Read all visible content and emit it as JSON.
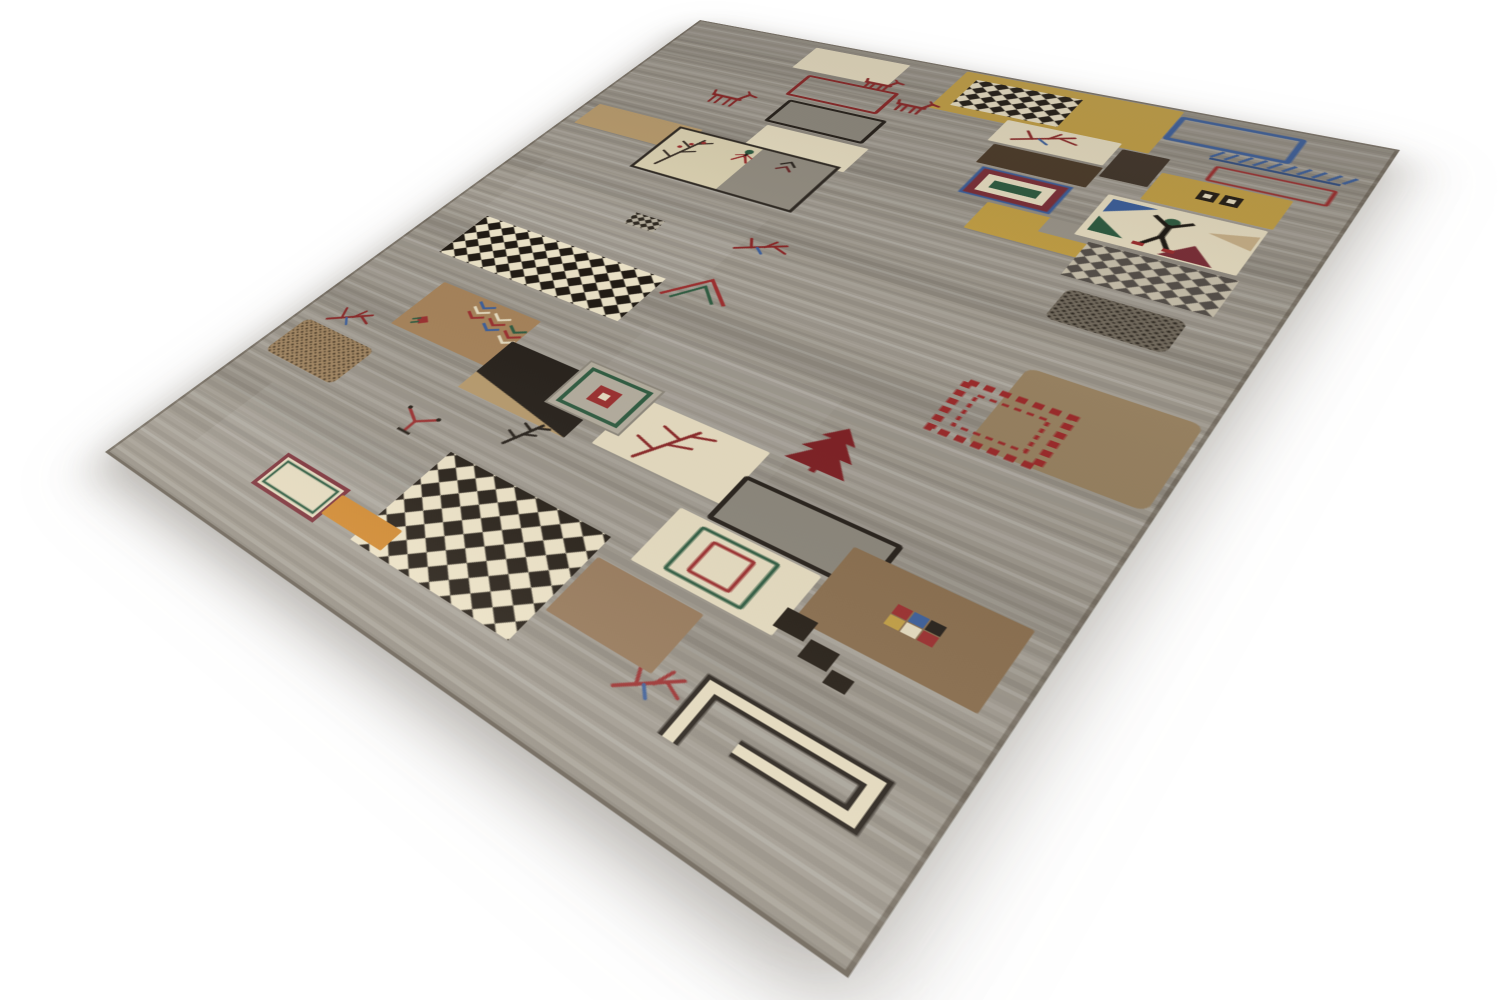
{
  "scene": {
    "description": "Product photograph of a hand-knotted Persian Gabbeh wool rug lying at a three-quarter angle on a plain white studio background. Gray striated field with a patchwork of cream, gold, brown and black squares, diagonal checkerboards and small tribal motifs: goats, birds, twigs, trees, a human figure, chevrons and dashed frames.",
    "background_color": "#ffffff",
    "rug": {
      "field_color": "#9b958a",
      "flat_width": 700,
      "flat_height": 980,
      "palette": {
        "field": "#9b958a",
        "cream": "#e7ddc1",
        "gold": "#c3a045",
        "tan": "#b99c6e",
        "tanlight": "#c9b189",
        "brown": "#a7835a",
        "brown2": "#968060",
        "brown3": "#8a6e4e",
        "brown4": "#97795a",
        "darkbrown": "#4c3b29",
        "darkbrown2": "#41352a",
        "blackish": "#26201a",
        "grayblock": "#8e897e",
        "grayblock2": "#8b867b",
        "blue": "#3c5f9b",
        "green": "#2f5c41",
        "red": "#9c2f2f",
        "darkred": "#8a2626",
        "maroon": "#7c2f38",
        "maroon2": "#7e2024",
        "orange": "#d2892e",
        "white": "#ffffff"
      },
      "motifs": [
        {
          "id": "gold-band",
          "type": "rect",
          "x": 330,
          "y": 4,
          "w": 205,
          "h": 90,
          "fill": "gold"
        },
        {
          "id": "checker-top",
          "type": "checker",
          "x": 346,
          "y": 18,
          "w": 104,
          "h": 62,
          "c1": "#211b14",
          "c2": "#e9dfc4",
          "cell": 11
        },
        {
          "id": "cream-rect-1",
          "type": "rect",
          "x": 163,
          "y": 14,
          "w": 110,
          "h": 55,
          "fill": "cream"
        },
        {
          "id": "goat-2",
          "type": "goat",
          "x": 248,
          "y": 52,
          "w": 38,
          "h": 28,
          "color": "darkred"
        },
        {
          "id": "red-outline-rect",
          "type": "rect",
          "x": 190,
          "y": 80,
          "w": 100,
          "h": 48,
          "stroke": "darkred",
          "sw": 4
        },
        {
          "id": "gray-outline-rect",
          "type": "rect",
          "x": 200,
          "y": 140,
          "w": 106,
          "h": 50,
          "fill": "grayblock",
          "stroke": "blackish",
          "sw": 4
        },
        {
          "id": "cream-rect-2",
          "type": "rect",
          "x": 206,
          "y": 198,
          "w": 112,
          "h": 52,
          "fill": "cream"
        },
        {
          "id": "goat-1",
          "type": "goat",
          "x": 116,
          "y": 141,
          "w": 48,
          "h": 38,
          "color": "darkred"
        },
        {
          "id": "goat-3",
          "type": "goat",
          "x": 298,
          "y": 82,
          "w": 40,
          "h": 30,
          "color": "darkred"
        },
        {
          "id": "cream-branch-sq",
          "type": "rect",
          "x": 406,
          "y": 86,
          "w": 104,
          "h": 46,
          "fill": "cream"
        },
        {
          "id": "branch-1",
          "type": "branch",
          "x": 424,
          "y": 90,
          "w": 56,
          "h": 36,
          "color": "darkred"
        },
        {
          "id": "dark-bar-2",
          "type": "rect",
          "x": 514,
          "y": 96,
          "w": 40,
          "h": 56,
          "fill": "darkbrown2"
        },
        {
          "id": "dark-bar",
          "type": "rect",
          "x": 414,
          "y": 136,
          "w": 98,
          "h": 40,
          "fill": "darkbrown"
        },
        {
          "id": "concentric-1",
          "type": "concentric",
          "x": 424,
          "y": 182,
          "w": 78,
          "h": 50,
          "rings": [
            "blue",
            "maroon",
            "cream"
          ],
          "center": "green"
        },
        {
          "id": "gold-L",
          "type": "rect",
          "x": 452,
          "y": 238,
          "w": 116,
          "h": 50,
          "fill": "gold"
        },
        {
          "id": "gold-L-notch",
          "type": "rect",
          "x": 506,
          "y": 238,
          "w": 62,
          "h": 26,
          "fill": "field"
        },
        {
          "id": "blue-outline-rect",
          "type": "rect",
          "x": 538,
          "y": 16,
          "w": 96,
          "h": 44,
          "stroke": "blue",
          "sw": 5
        },
        {
          "id": "blue-comb",
          "type": "comb",
          "x": 580,
          "y": 62,
          "w": 110,
          "h": 22,
          "color": "blue"
        },
        {
          "id": "red-thin-rect",
          "type": "rect",
          "x": 590,
          "y": 92,
          "w": 88,
          "h": 26,
          "stroke": "red",
          "sw": 3
        },
        {
          "id": "gold-sq-68",
          "type": "rect",
          "x": 556,
          "y": 122,
          "w": 100,
          "h": 52,
          "fill": "gold"
        },
        {
          "id": "motif-68",
          "type": "dblsq",
          "x": 592,
          "y": 136,
          "w": 32,
          "h": 17
        },
        {
          "id": "figure-square",
          "type": "rect",
          "x": 532,
          "y": 178,
          "w": 122,
          "h": 76,
          "fill": "cream"
        },
        {
          "id": "tri-blue",
          "type": "tri",
          "x": 538,
          "y": 184,
          "w": 36,
          "h": 24,
          "fill": "blue",
          "dir": "tl"
        },
        {
          "id": "tri-green",
          "type": "tri",
          "x": 538,
          "y": 216,
          "w": 28,
          "h": 26,
          "fill": "green",
          "dir": "bl"
        },
        {
          "id": "tri-maroon",
          "type": "tri",
          "x": 596,
          "y": 226,
          "w": 40,
          "h": 26,
          "fill": "maroon",
          "dir": "b"
        },
        {
          "id": "tri-tan",
          "type": "tri",
          "x": 618,
          "y": 190,
          "w": 34,
          "h": 24,
          "fill": "tanlight",
          "dir": "r"
        },
        {
          "id": "human-figure",
          "type": "human",
          "x": 572,
          "y": 192,
          "w": 36,
          "h": 52
        },
        {
          "id": "checker-gray",
          "type": "checker",
          "x": 546,
          "y": 260,
          "w": 112,
          "h": 58,
          "c1": "#56504a",
          "c2": "#c8c0ac",
          "cell": 10
        },
        {
          "id": "speckle-dark",
          "type": "speckle",
          "x": 558,
          "y": 334,
          "w": 88,
          "h": 48,
          "base": "#746c5f",
          "dots": "#2d2720"
        },
        {
          "id": "tan-sq",
          "type": "rect",
          "x": 16,
          "y": 238,
          "w": 136,
          "h": 50,
          "fill": "tan"
        },
        {
          "id": "panel-left",
          "type": "panel",
          "x": 128,
          "y": 244,
          "w": 182,
          "h": 94
        },
        {
          "id": "bug-1",
          "type": "bug",
          "x": 206,
          "y": 252,
          "w": 26,
          "h": 26
        },
        {
          "id": "branch-mid",
          "type": "branch",
          "x": 298,
          "y": 388,
          "w": 46,
          "h": 36,
          "color": "darkred"
        },
        {
          "id": "mini-check",
          "type": "checker",
          "x": 184,
          "y": 412,
          "w": 34,
          "h": 22,
          "c1": "#302a22",
          "c2": "#b3ac9c",
          "cell": 6
        },
        {
          "id": "checker-left",
          "type": "checker",
          "x": 54,
          "y": 494,
          "w": 218,
          "h": 78,
          "c1": "#211b14",
          "c2": "#ece3c8",
          "cell": 13
        },
        {
          "id": "arrow-pair",
          "type": "arrows",
          "x": 280,
          "y": 474,
          "w": 58,
          "h": 42
        },
        {
          "id": "chevron-sq",
          "type": "rect",
          "x": 94,
          "y": 610,
          "w": 120,
          "h": 80,
          "fill": "brown"
        },
        {
          "id": "chevrons",
          "type": "chevrons",
          "x": 146,
          "y": 616,
          "w": 72,
          "h": 46
        },
        {
          "id": "rose",
          "type": "rose",
          "x": 108,
          "y": 660,
          "w": 18,
          "h": 18
        },
        {
          "id": "black-sq",
          "type": "rect",
          "x": 210,
          "y": 648,
          "w": 116,
          "h": 78,
          "fill": "blackish"
        },
        {
          "id": "black-sq-streak",
          "type": "tri",
          "x": 210,
          "y": 700,
          "w": 116,
          "h": 26,
          "fill": "tan",
          "dir": "bl"
        },
        {
          "id": "cream-branch-sq-2",
          "type": "rect",
          "x": 348,
          "y": 648,
          "w": 118,
          "h": 70,
          "fill": "cream"
        },
        {
          "id": "tree-twig",
          "type": "tree",
          "x": 374,
          "y": 656,
          "w": 62,
          "h": 56,
          "color": "darkred"
        },
        {
          "id": "concentric-2",
          "type": "concentric2",
          "x": 286,
          "y": 632,
          "w": 74,
          "h": 66
        },
        {
          "id": "red-tree",
          "type": "pine",
          "x": 476,
          "y": 590,
          "w": 48,
          "h": 58,
          "color": "maroon2"
        },
        {
          "id": "brown-sq-right",
          "type": "rect",
          "x": 574,
          "y": 450,
          "w": 120,
          "h": 108,
          "fill": "brown2",
          "rx": 8
        },
        {
          "id": "ladder-frame",
          "type": "ladder",
          "x": 546,
          "y": 490,
          "w": 76,
          "h": 66,
          "color": "#9a2b2b"
        },
        {
          "id": "gray-outline-rect-2",
          "type": "rect",
          "x": 466,
          "y": 682,
          "w": 118,
          "h": 52,
          "fill": "grayblock2",
          "stroke": "blackish",
          "sw": 4
        },
        {
          "id": "cream-concentric-sq",
          "type": "rect",
          "x": 444,
          "y": 738,
          "w": 112,
          "h": 66,
          "fill": "cream"
        },
        {
          "id": "green-rect-line",
          "type": "rect",
          "x": 468,
          "y": 746,
          "w": 60,
          "h": 50,
          "stroke": "green",
          "sw": 3
        },
        {
          "id": "red-rect-line",
          "type": "rect",
          "x": 482,
          "y": 754,
          "w": 32,
          "h": 34,
          "stroke": "red",
          "sw": 3
        },
        {
          "id": "brown-sq-bottom",
          "type": "rect",
          "x": 560,
          "y": 700,
          "w": 120,
          "h": 82,
          "fill": "brown3"
        },
        {
          "id": "mini-squares",
          "type": "minis",
          "x": 606,
          "y": 730,
          "w": 34,
          "h": 22
        },
        {
          "id": "black-steps",
          "type": "steps",
          "x": 552,
          "y": 776,
          "w": 84,
          "h": 44
        },
        {
          "id": "hook-motif",
          "type": "hook",
          "x": 538,
          "y": 854,
          "w": 132,
          "h": 66
        },
        {
          "id": "branch-bottom",
          "type": "branch",
          "x": 498,
          "y": 866,
          "w": 40,
          "h": 44,
          "color": "red"
        },
        {
          "id": "speckle-brown",
          "type": "speckle",
          "x": 16,
          "y": 730,
          "w": 94,
          "h": 60,
          "base": "#a28560",
          "dots": "#4c3b26"
        },
        {
          "id": "branch-left",
          "type": "branch",
          "x": 34,
          "y": 686,
          "w": 42,
          "h": 40,
          "color": "darkred"
        },
        {
          "id": "wineglass",
          "type": "wineglass",
          "x": 190,
          "y": 768,
          "w": 38,
          "h": 38
        },
        {
          "id": "plant-dark",
          "type": "tree",
          "x": 284,
          "y": 722,
          "w": 32,
          "h": 38,
          "color": "blackish"
        },
        {
          "id": "checker-bottom",
          "type": "checker",
          "x": 260,
          "y": 794,
          "w": 160,
          "h": 124,
          "c1": "#241d15",
          "c2": "#eee4c8",
          "cell": 15
        },
        {
          "id": "brown-sq-checker",
          "type": "rect",
          "x": 424,
          "y": 816,
          "w": 88,
          "h": 64,
          "fill": "brown4"
        },
        {
          "id": "outlined-rect-small",
          "type": "orect3",
          "x": 146,
          "y": 880,
          "w": 74,
          "h": 42
        },
        {
          "id": "orange-bar",
          "type": "rect",
          "x": 220,
          "y": 886,
          "w": 68,
          "h": 26,
          "fill": "orange"
        }
      ]
    }
  }
}
